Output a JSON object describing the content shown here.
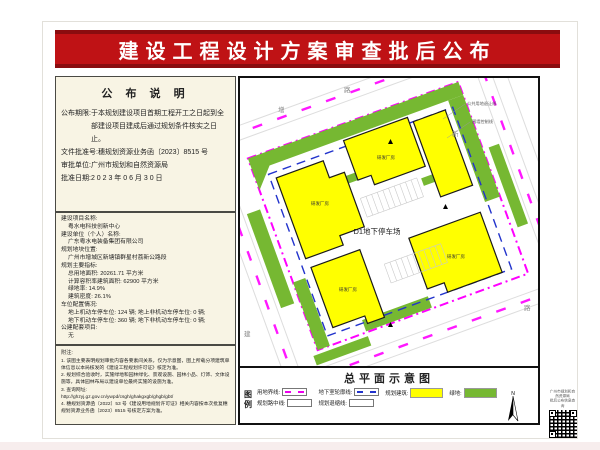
{
  "header": {
    "title": "建设工程设计方案审查批后公布",
    "banner_color": "#bf1215"
  },
  "announcement": {
    "title": "公 布 说 明",
    "lines": [
      {
        "label": "公布期限:",
        "value": "于本规划建设项目首期工程开工之日起到全部建设项目建成后通过规划条件核实之日止。"
      },
      {
        "label": "文件批准号:",
        "value": "穗规划资源业务函〔2023〕8515 号"
      },
      {
        "label": "审批单位:",
        "value": "广州市规划和自然资源局"
      },
      {
        "label": "批准日期:",
        "value": "2 0 2 3 年 0 6 月 3 0 日"
      }
    ]
  },
  "project": {
    "name_label": "建设项目名称:",
    "name": "粤水电科技创新中心",
    "unit_label": "建设单位（个人）名称:",
    "unit": "广东粤水电装备集团有限公司",
    "location_label": "规划地块位置:",
    "location": "广州市增城区新塘镇群星村荔新公路段",
    "indicators_label": "规划主要指标:",
    "indicators": [
      "总用地面积: 20261.71  平方米",
      "计算容积率建筑面积: 62900  平方米",
      "绿地率: 14.9%",
      "建筑密度: 26.1%"
    ],
    "parking_label": "车位配置情况:",
    "parking": [
      "地上机动车停车位: 124 辆; 地上非机动车停车位: 0 辆;",
      "地下机动车停车位: 360 辆; 地下非机动车停车位: 0 辆;"
    ],
    "public_label": "公建配套项目:",
    "public_value": "无"
  },
  "notes": {
    "title": "附注:",
    "items": [
      "1. 该图主要表明规划审批内容各要素间关系，仅为示意图，图上所载分项建筑单体信息以本局核发的《建设工程规划许可证》核定为准。",
      "2. 规划综合验收时，实施绿地和园林绿化、景观设施、园林小品、灯饰、文体设施等，具体园林布局以建设单位最终实施的设施为准。",
      "3. 查询网址:",
      "http://ghzyj.gz.gov.cn/ywpd/csgh/ghakgxgb/ghgb/gbt/",
      "4. 穗规划资源函〔2022〕53 号《建设用地规划许可证》相关内容按本次批复穗规划资源业务函〔2023〕8515 号核定方案为准。"
    ]
  },
  "map": {
    "parking_garage_label": "D1地下停车场",
    "building_labels": [
      "研发厂房",
      "研发厂房",
      "研发厂房",
      "研发厂房"
    ],
    "callouts": [
      "公共用地退让线",
      "围墙控制线"
    ],
    "road_chars": [
      "增",
      "路",
      "新",
      "路",
      "建"
    ],
    "colors": {
      "building": "#ffff00",
      "green_space": "#76b832",
      "site_boundary": "#ff00ff",
      "basement_outline": "#2233cc"
    }
  },
  "legend": {
    "title": "总平面示意图",
    "caption": "图例",
    "items": [
      {
        "label": "用地界线:"
      },
      {
        "label": "规划路中线:"
      },
      {
        "label": "地下室轮廓线:"
      },
      {
        "label": "规划退缩线:"
      },
      {
        "label": "规划建筑:"
      },
      {
        "label": "绿地:"
      }
    ],
    "north_label": "N"
  },
  "qr": {
    "caption_line1": "广州市规划和自然资源局",
    "caption_line2": "批后公布信息查询"
  }
}
